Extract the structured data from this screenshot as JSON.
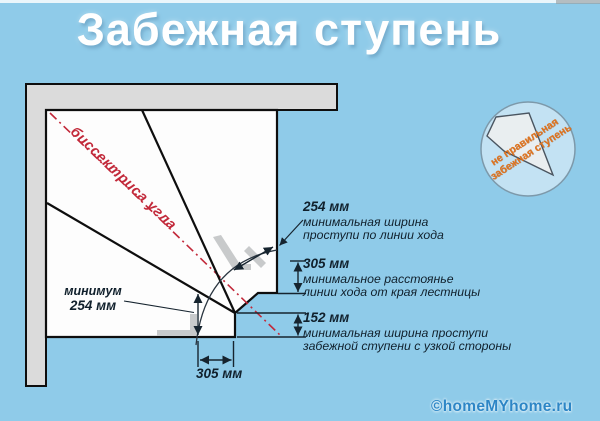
{
  "title": "Забежная ступень",
  "colors": {
    "background": "#8fcbe9",
    "wall_fill": "#dbdbdb",
    "stair_fill": "#fdfdfd",
    "outline": "#0e0e0e",
    "bisector_red": "#c2293a",
    "badge_text_orange": "#e0731d",
    "watermark_blue": "#2d86c6",
    "annotation_text": "#10202c"
  },
  "diagram": {
    "bisector_label": "биссектриса угла",
    "annotations": {
      "tread_width": {
        "value": "254 мм",
        "lines": [
          "минимальная ширина",
          "проступи по линии хода"
        ]
      },
      "walk_line_distance": {
        "value": "305 мм",
        "lines": [
          "минимальное расстоянье",
          "линии хода от края лестницы"
        ]
      },
      "narrow_width": {
        "value": "152 мм",
        "lines": [
          "минимальная ширина проступи",
          "забежной ступени с узкой стороны"
        ]
      },
      "minimum": {
        "line1": "минимум",
        "line2": "254 мм"
      },
      "bottom_dim": "305 мм"
    },
    "badge": {
      "line1": "не правильная",
      "line2": "забежная ступень"
    }
  },
  "watermark": "©homeMYhome.ru"
}
